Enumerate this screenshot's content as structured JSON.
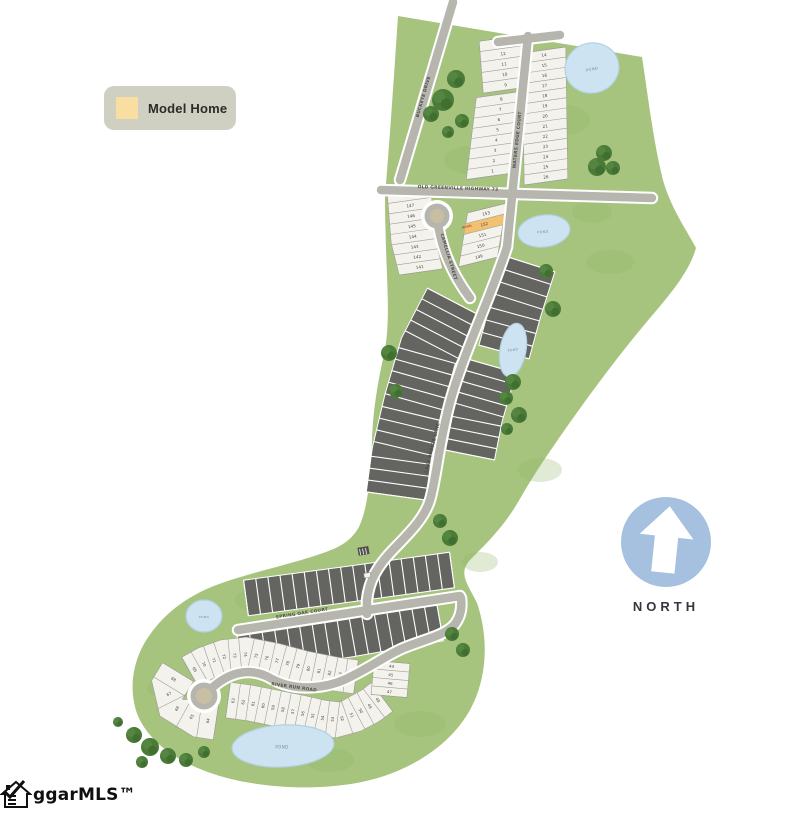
{
  "legend": {
    "model_home_label": "Model Home",
    "swatch_color": "#f8dfa1"
  },
  "north_indicator": {
    "label": "NORTH"
  },
  "logo": {
    "text": "ggarMLS™"
  },
  "map": {
    "pond_label": "POND",
    "model_home": {
      "lot_number": "152",
      "tag": "MODEL"
    },
    "roads": [
      {
        "id": "buckeye",
        "name": "BUCKEYE DRIVE"
      },
      {
        "id": "old-greenville",
        "name": "OLD GREENVILLE HIGHWAY 73"
      },
      {
        "id": "waters-edge",
        "name": "WATERS EDGE COURT"
      },
      {
        "id": "camellia",
        "name": "CAMELLIA STREET"
      },
      {
        "id": "lake-breeze",
        "name": "LAKE BREEZE LANE"
      },
      {
        "id": "spring-oak",
        "name": "SPRING OAK COURT"
      },
      {
        "id": "river-run",
        "name": "RIVER RUN ROAD"
      }
    ],
    "lot_groups": [
      {
        "id": "waters-edge-west-upper",
        "numbers": [
          "13",
          "12",
          "11",
          "10",
          "9"
        ]
      },
      {
        "id": "waters-edge-west-lower",
        "numbers": [
          "8",
          "7",
          "6",
          "5",
          "4",
          "3",
          "2",
          "1"
        ]
      },
      {
        "id": "waters-edge-east",
        "numbers": [
          "14",
          "15",
          "16",
          "17",
          "18",
          "19",
          "20",
          "21",
          "22",
          "23",
          "24",
          "25",
          "26"
        ]
      },
      {
        "id": "camellia-west",
        "numbers": [
          "148",
          "147",
          "146",
          "145",
          "144",
          "143",
          "142",
          "141"
        ]
      },
      {
        "id": "camellia-east",
        "numbers": [
          "153",
          "152",
          "151",
          "150",
          "149"
        ]
      },
      {
        "id": "river-run-upper",
        "numbers": [
          "69",
          "70",
          "71",
          "72",
          "73",
          "74",
          "75",
          "76",
          "77",
          "78",
          "79",
          "80",
          "81",
          "82",
          "83",
          "84"
        ]
      },
      {
        "id": "river-run-lower",
        "numbers": [
          "63",
          "62",
          "61",
          "60",
          "59",
          "58",
          "57",
          "56",
          "55",
          "54",
          "53",
          "52",
          "51",
          "50",
          "49",
          "48"
        ]
      },
      {
        "id": "river-run-east-fan",
        "numbers": [
          "44",
          "45",
          "46",
          "47"
        ]
      },
      {
        "id": "river-run-culdesac",
        "numbers": [
          "68",
          "67",
          "66",
          "65",
          "64"
        ]
      }
    ],
    "colors": {
      "greenspace": "#a6c47d",
      "grass_patch": "#93b567",
      "road": "#b6b6ae",
      "road_casing": "#ffffff",
      "lot_available": "#f3f2ec",
      "lot_line": "#9f9f97",
      "lot_sold": "#646461",
      "pond": "#cde3f1",
      "pond_edge": "#b2d0e4",
      "pond_text": "#6d8fa8",
      "model_home": "#f2c172",
      "model_tag_text": "#c34b35",
      "tree_dark": "#3e6d2f",
      "tree_mid": "#4a7b39",
      "tree_light": "#578a44",
      "label_text": "#51514a",
      "number_text": "#45453d",
      "north_circle": "#a6c1df",
      "legend_bg": "#cfcfc2",
      "culdesac_center": "#c8bfa3"
    }
  }
}
